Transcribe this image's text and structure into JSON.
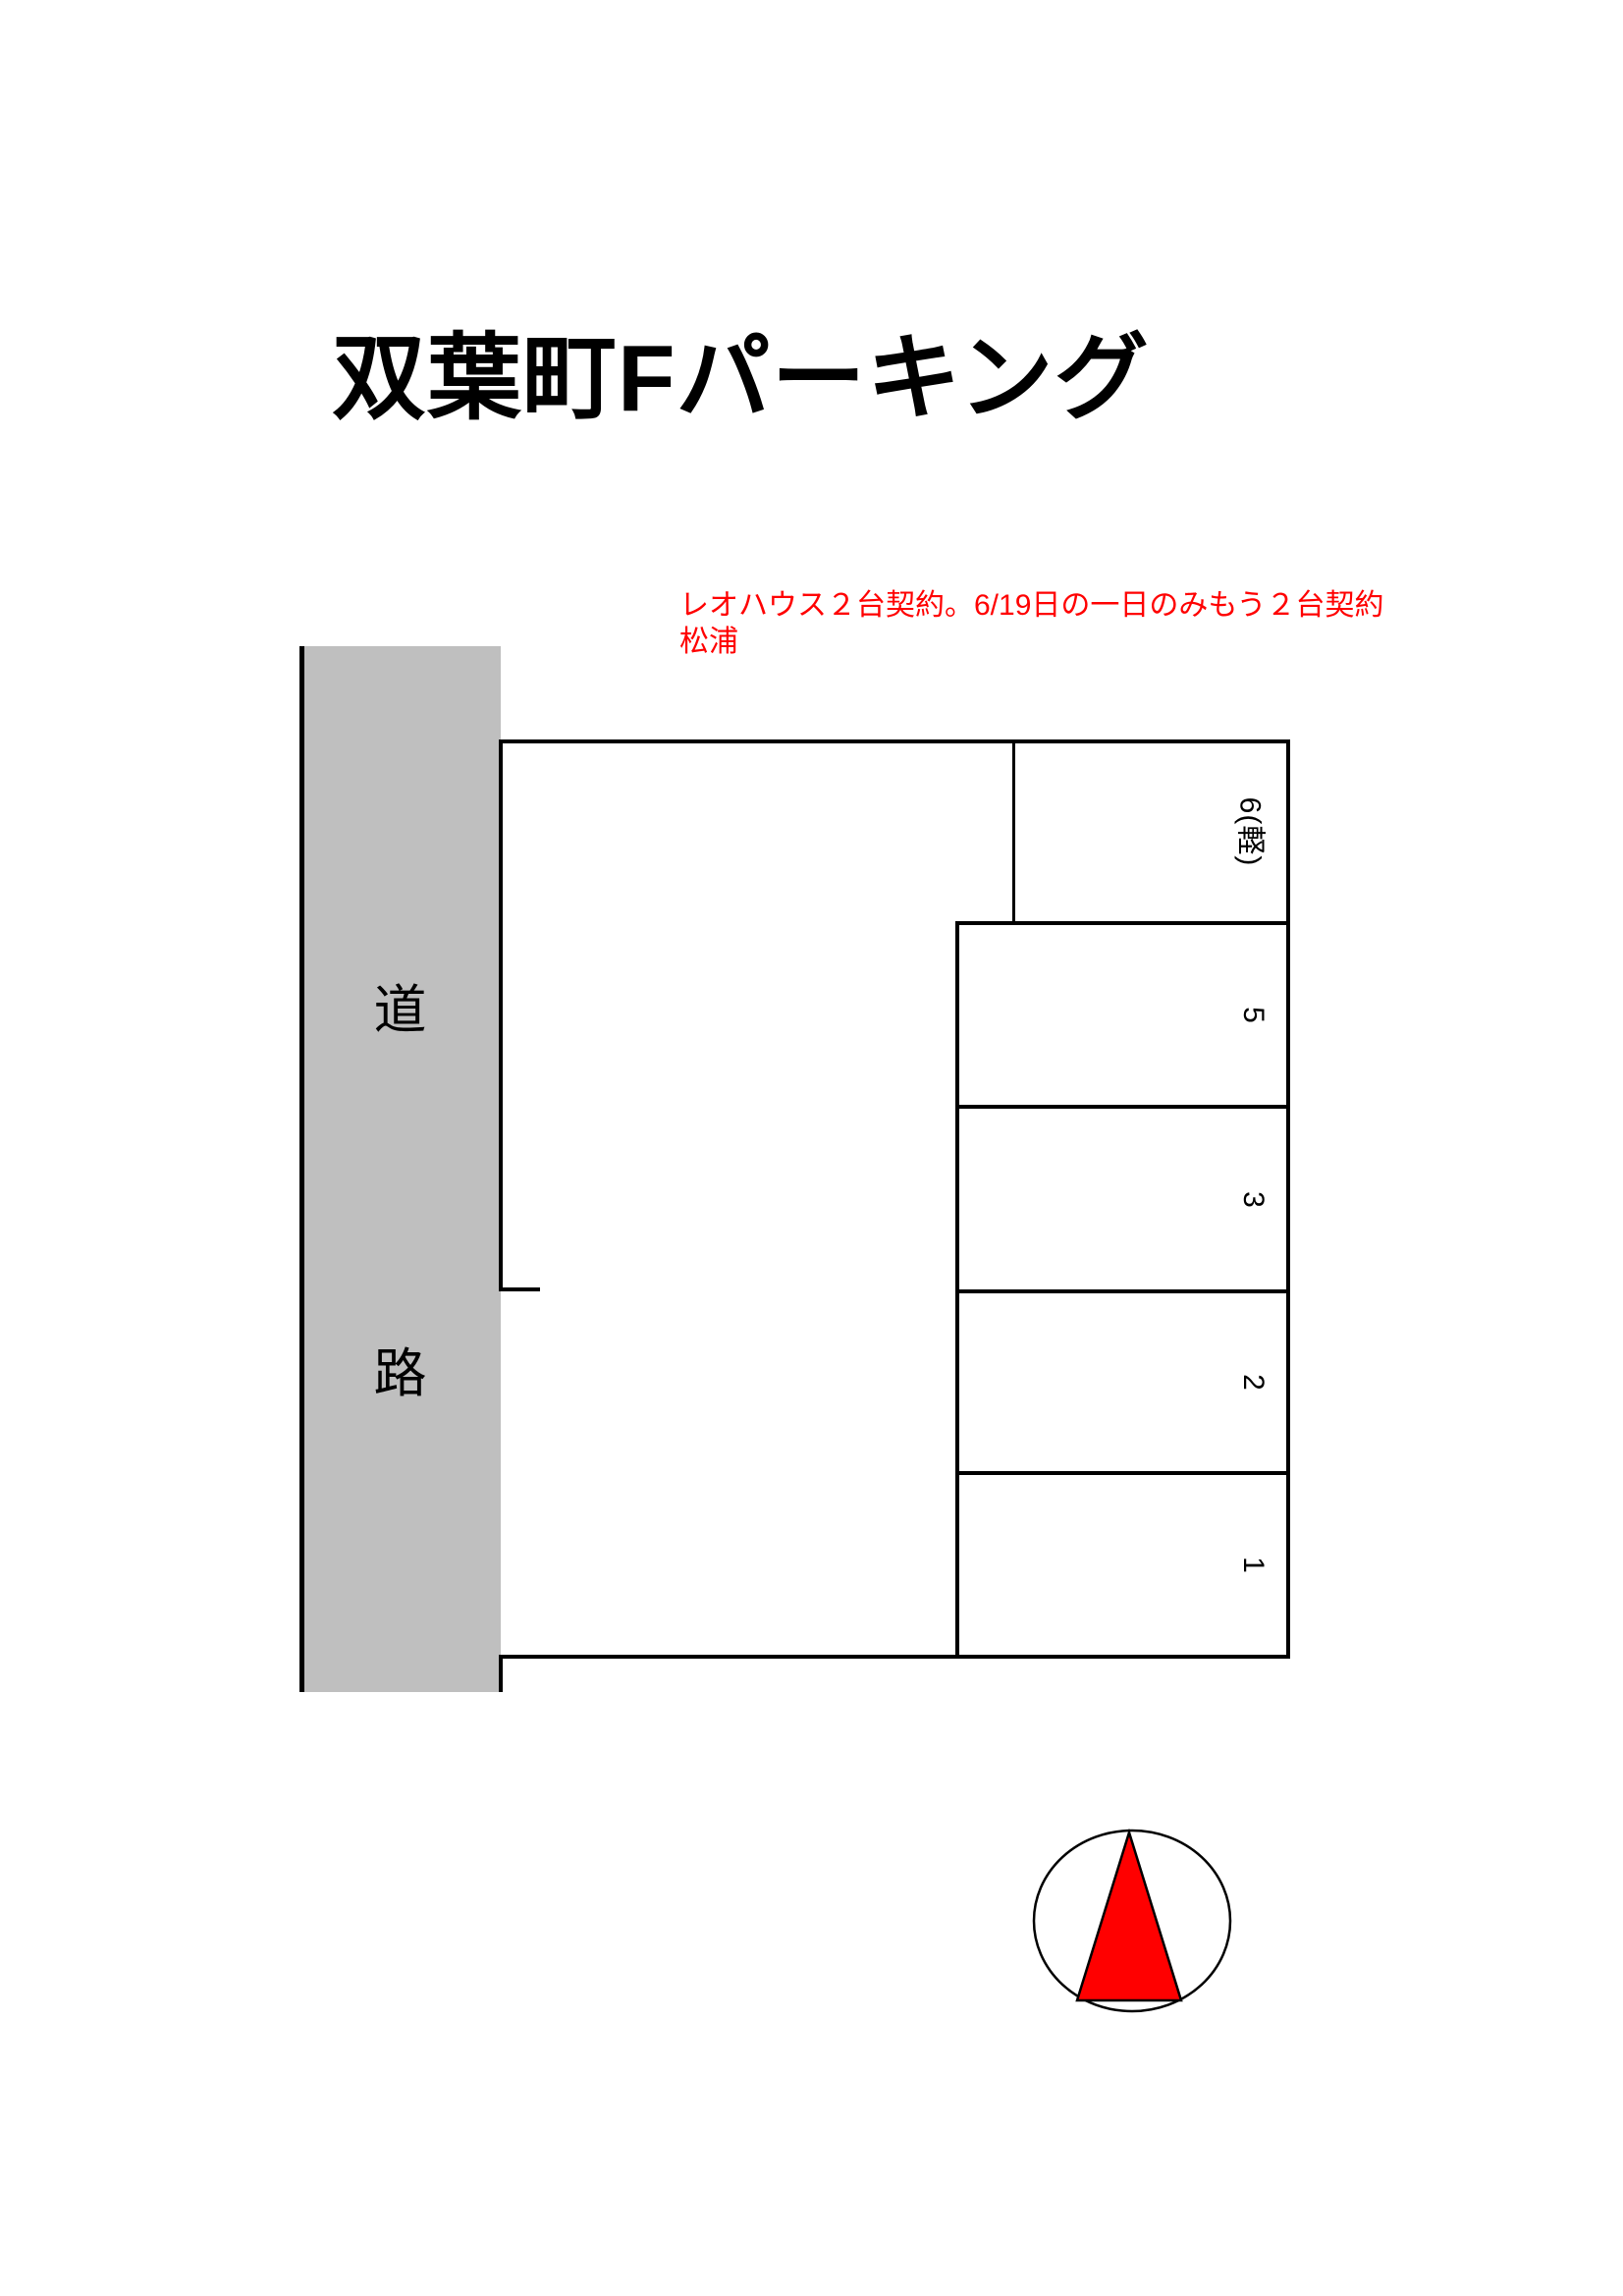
{
  "title": "双葉町Fパーキング",
  "note": {
    "line1": "レオハウス２台契約。6/19日の一日のみもう２台契約",
    "line2": "松浦",
    "color": "#ff0000"
  },
  "road": {
    "label_top": "道",
    "label_bottom": "路",
    "fill_color": "#bfbfbf"
  },
  "spaces": [
    {
      "label": "6(軽)"
    },
    {
      "label": "5"
    },
    {
      "label": "3"
    },
    {
      "label": "2"
    },
    {
      "label": "1"
    }
  ],
  "compass": {
    "icon": "north-arrow",
    "triangle_color": "#ff0000",
    "outline_color": "#000000"
  }
}
